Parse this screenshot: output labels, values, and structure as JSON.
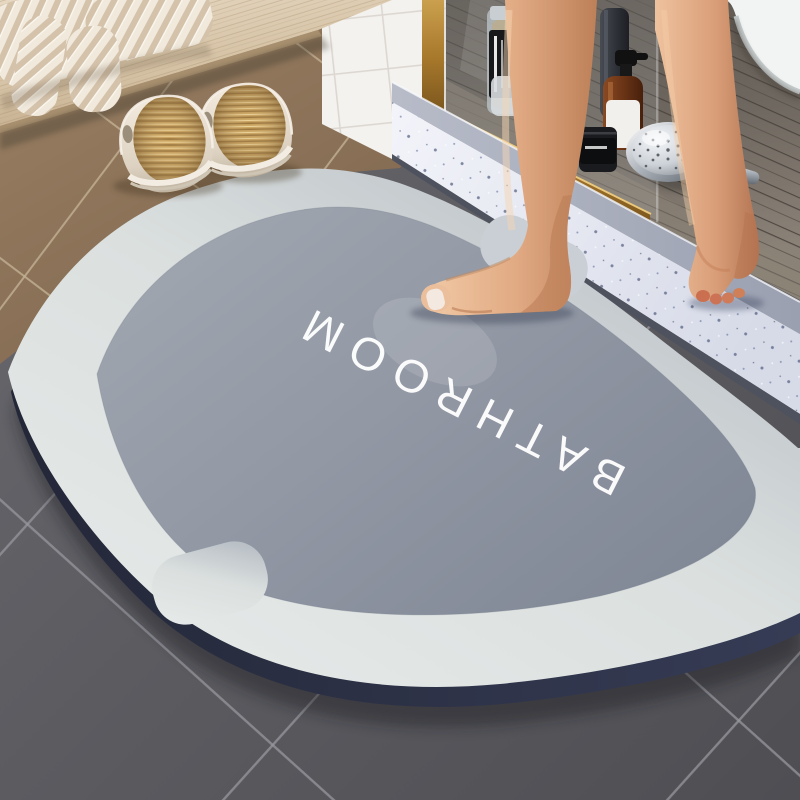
{
  "scene": {
    "kind": "bathroom product photo",
    "subject": "super-absorbent diatomite bath mat at shower entrance"
  },
  "mat": {
    "label": "BATHROOM",
    "colors": {
      "edge_navy": "#2b3044",
      "border_light": "#e2e6e5",
      "border_shaded": "#b3bac1",
      "inner_light": "#a0a6b0",
      "inner_dark": "#848b99",
      "text": "#ffffff"
    }
  },
  "floor": {
    "tile_dark": "#59595e",
    "tile_grout": "#97979d",
    "tile_brown": "#8b7157",
    "brown_grout": "#c3b093"
  },
  "shower": {
    "threshold_top": "#ecEEf6",
    "threshold_face": "#a9adbb",
    "plank_floor": "#6e6760",
    "brass_frame": "#b28434",
    "tile_wall": "#f4f2ee",
    "tub": "#f2f4f4"
  },
  "objects": {
    "bench": "wooden-bench",
    "towel": "striped-towel",
    "slippers": "pair-of-cream-slippers",
    "bottles": [
      "clear-bottle-black-label",
      "slate-tall-bottle",
      "amber-pump-bottle",
      "black-jar"
    ],
    "shower_head": "chrome-shower-head",
    "legs": "person-standing-bare-feet"
  }
}
